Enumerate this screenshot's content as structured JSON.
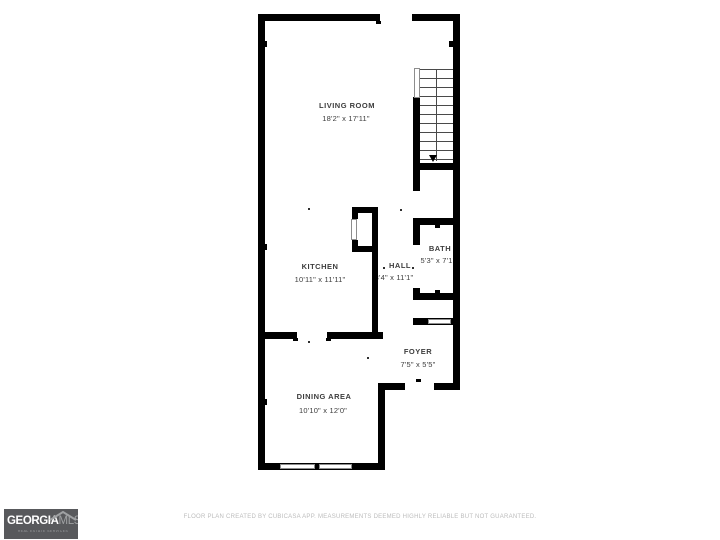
{
  "floor_plan": {
    "rooms": [
      {
        "name": "LIVING ROOM",
        "dimensions": "18'2\" x 17'11\""
      },
      {
        "name": "KITCHEN",
        "dimensions": "10'11\" x 11'11\""
      },
      {
        "name": "HALL",
        "dimensions": "3'4\" x 11'1\""
      },
      {
        "name": "BATH",
        "dimensions": "5'3\" x 7'1\""
      },
      {
        "name": "FOYER",
        "dimensions": "7'5\" x 5'5\""
      },
      {
        "name": "DINING AREA",
        "dimensions": "10'10\" x 12'0\""
      }
    ],
    "wall_color": "#000000"
  },
  "branding": {
    "logo_primary": "GEORGIA",
    "logo_secondary": "MLS",
    "logo_tagline": "REAL ESTATE SERVICES",
    "logo_background": "#58595c",
    "logo_accent": "#9fa1a3"
  },
  "footer": {
    "disclaimer": "FLOOR PLAN CREATED BY CUBICASA APP. MEASUREMENTS DEEMED HIGHLY RELIABLE BUT NOT GUARANTEED."
  }
}
